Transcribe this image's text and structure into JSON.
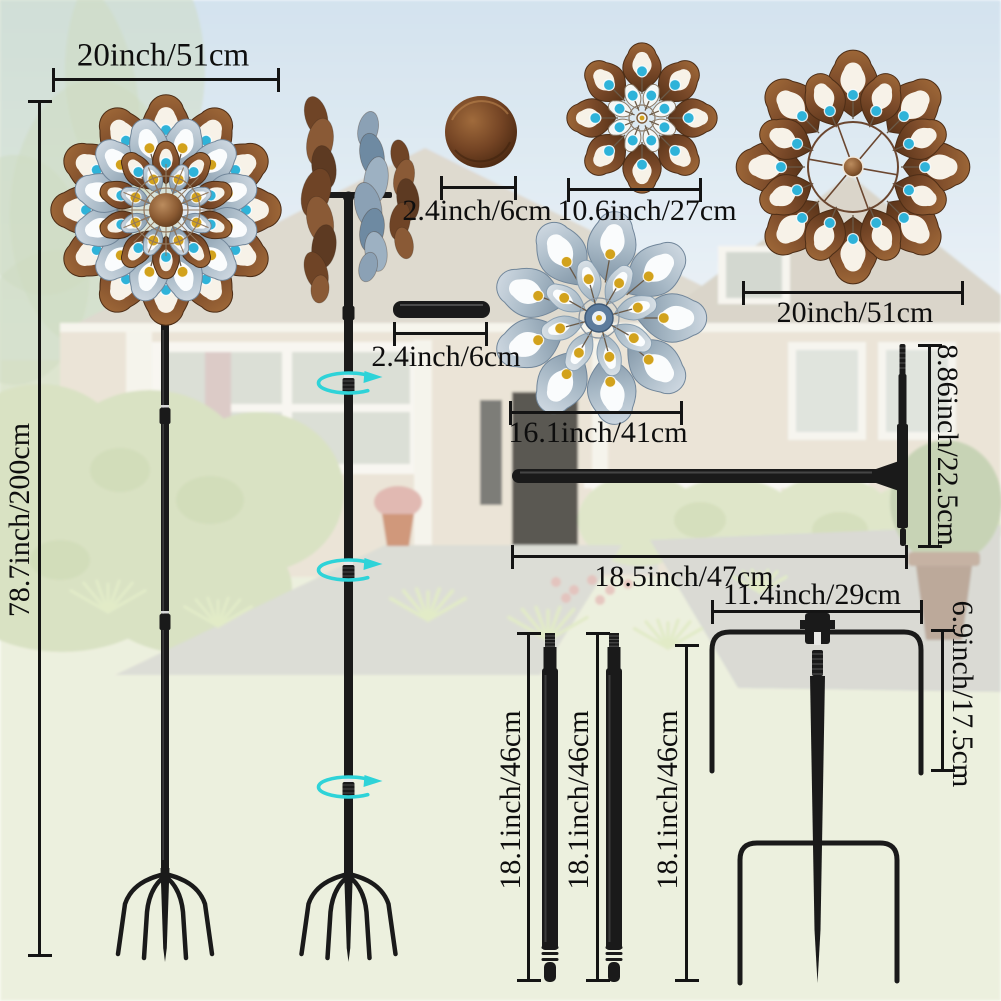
{
  "image_type": "wind-spinner product dimension diagram",
  "labels": {
    "spinner_width": "20inch/51cm",
    "total_height": "78.7inch/200cm",
    "cap_diameter": "2.4inch/6cm",
    "small_flower_diameter": "10.6inch/27cm",
    "large_flower_diameter": "20inch/51cm",
    "connector_tube_length": "2.4inch/6cm",
    "blue_flower_diameter": "16.1inch/41cm",
    "crossbar_height": "8.86inch/22.5cm",
    "crossbar_length": "18.5inch/47cm",
    "stake_top_width": "11.4inch/29cm",
    "stake_prong_height": "6.9inch/17.5cm",
    "pole_length_1": "18.1inch/46cm",
    "pole_length_2": "18.1inch/46cm",
    "pole_length_3": "18.1inch/46cm"
  },
  "colors": {
    "bronze": "#7c4b2a",
    "bronze_light": "#9c6637",
    "bronze_dark": "#5a3419",
    "silver_blue": "#a9bac7",
    "silver_blue_dark": "#8397a8",
    "gem_blue": "#2fb3d9",
    "gem_amber": "#d2a21c",
    "metal_black": "#1a1a1a",
    "dimension_line": "#141414",
    "rotation_arrow": "#2ed3d8",
    "sky": "#cfe0ed",
    "lawn": "#ebefdb"
  }
}
